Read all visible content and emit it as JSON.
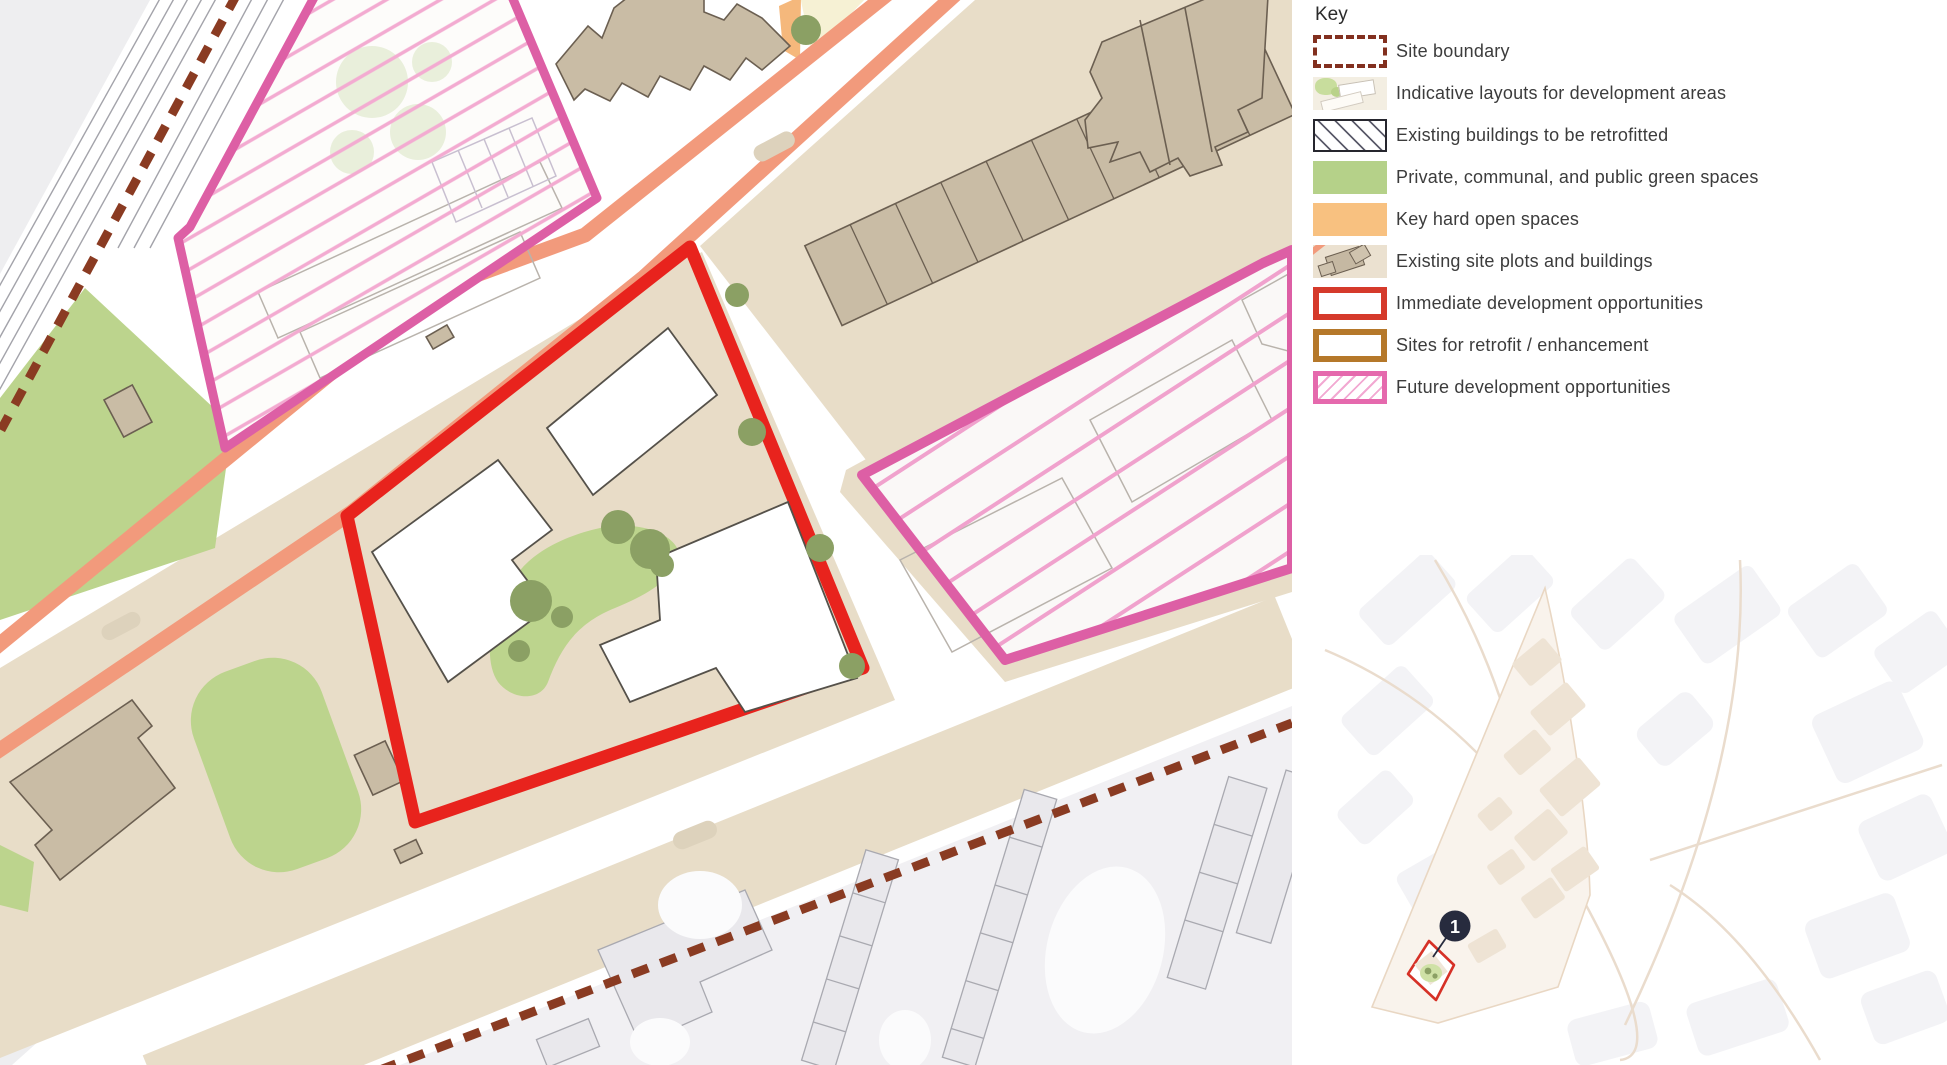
{
  "legend": {
    "title": "Key",
    "items": [
      {
        "id": "site-boundary",
        "label": "Site boundary"
      },
      {
        "id": "indicative",
        "label": "Indicative layouts for development areas"
      },
      {
        "id": "retrofit-hatch",
        "label": "Existing buildings to be retrofitted"
      },
      {
        "id": "green-spaces",
        "label": "Private, communal, and public green spaces"
      },
      {
        "id": "hard-spaces",
        "label": "Key hard open spaces"
      },
      {
        "id": "existing-plots",
        "label": "Existing site plots and buildings"
      },
      {
        "id": "immediate",
        "label": "Immediate development opportunities"
      },
      {
        "id": "retrofit-sites",
        "label": "Sites for retrofit / enhancement"
      },
      {
        "id": "future",
        "label": "Future development opportunities"
      }
    ]
  },
  "inset": {
    "marker_label": "1"
  },
  "colors": {
    "site_boundary_dash": "#82301f",
    "immediate_red": "#e8231d",
    "retrofit_ochre": "#b5782a",
    "future_magenta": "#e569ad",
    "hatch_pink": "#f2a9d2",
    "green_space": "#b5d189",
    "hard_space_orange": "#f8c180",
    "existing_taupe": "#c9bca5",
    "road_salmon": "#f29a7c",
    "plot_beige": "#e8ddc8",
    "context_grey": "#e9e8ec",
    "marker_badge_navy": "#272b3e"
  }
}
